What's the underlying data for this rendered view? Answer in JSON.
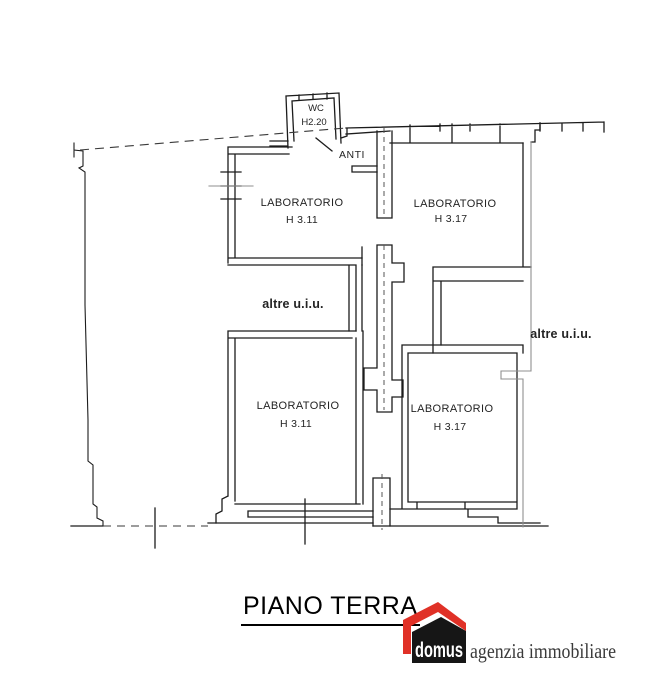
{
  "document": {
    "title": "PIANO TERRA"
  },
  "plan": {
    "rooms": [
      {
        "id": "wc",
        "name": "WC",
        "height": "H2.20"
      },
      {
        "id": "anti",
        "name": "ANTI",
        "height": ""
      },
      {
        "id": "lab-top-left",
        "name": "LABORATORIO",
        "height": "H 3.11"
      },
      {
        "id": "lab-top-right",
        "name": "LABORATORIO",
        "height": "H 3.17"
      },
      {
        "id": "lab-bot-left",
        "name": "LABORATORIO",
        "height": "H 3.11"
      },
      {
        "id": "lab-bot-right",
        "name": "LABORATORIO",
        "height": "H 3.17"
      }
    ],
    "annotations": {
      "altre_left": "altre u.i.u.",
      "altre_right": "altre u.i.u."
    }
  },
  "branding": {
    "logo_text": "domus",
    "agency_text": "agenzia immobiliare",
    "logo_red": "#e03127",
    "logo_black": "#161616"
  },
  "colors": {
    "wall": "#1c1c1c",
    "secondary_line": "#8f8f8f",
    "text": "#232323",
    "background": "#ffffff"
  }
}
